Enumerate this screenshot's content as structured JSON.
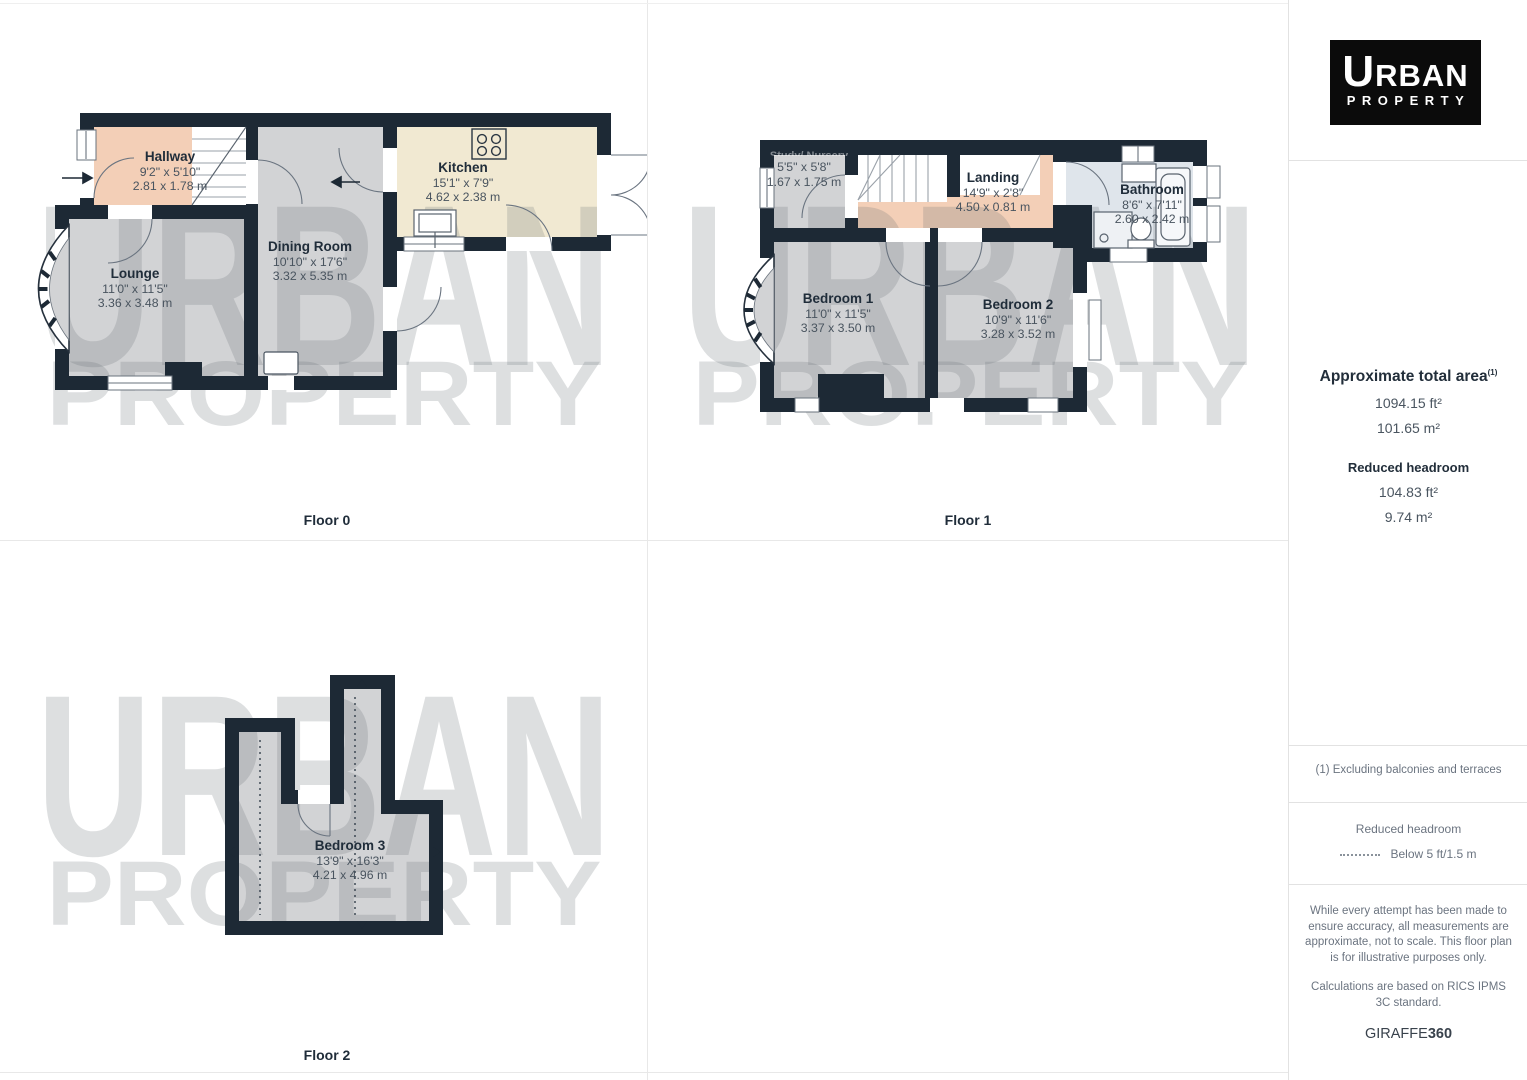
{
  "branding": {
    "logo_word1_first": "U",
    "logo_word1_rest": "RBAN",
    "logo_word2": "PROPERTY"
  },
  "watermark": {
    "line1": "URBAN",
    "line2": "PROPERTY"
  },
  "floors": [
    {
      "label": "Floor 0",
      "rooms": [
        {
          "name": "Hallway",
          "imperial": "9'2\" x 5'10\"",
          "metric": "2.81 x 1.78 m"
        },
        {
          "name": "Lounge",
          "imperial": "11'0\" x 11'5\"",
          "metric": "3.36 x 3.48 m"
        },
        {
          "name": "Dining Room",
          "imperial": "10'10\" x 17'6\"",
          "metric": "3.32 x 5.35 m"
        },
        {
          "name": "Kitchen",
          "imperial": "15'1\" x 7'9\"",
          "metric": "4.62 x 2.38 m"
        }
      ]
    },
    {
      "label": "Floor 1",
      "rooms": [
        {
          "name": "Study/ Nursery",
          "imperial": "5'5\" x 5'8\"",
          "metric": "1.67 x 1.75 m"
        },
        {
          "name": "Landing",
          "imperial": "14'9\" x 2'8\"",
          "metric": "4.50 x 0.81 m"
        },
        {
          "name": "Bathroom",
          "imperial": "8'6\" x 7'11\"",
          "metric": "2.60 x 2.42 m"
        },
        {
          "name": "Bedroom 1",
          "imperial": "11'0\" x 11'5\"",
          "metric": "3.37 x 3.50 m"
        },
        {
          "name": "Bedroom 2",
          "imperial": "10'9\" x 11'6\"",
          "metric": "3.28 x 3.52 m"
        }
      ]
    },
    {
      "label": "Floor 2",
      "rooms": [
        {
          "name": "Bedroom 3",
          "imperial": "13'9\" x 16'3\"",
          "metric": "4.21 x 4.96 m"
        }
      ]
    }
  ],
  "sidebar": {
    "total_area": {
      "heading": "Approximate total area",
      "sup": "(1)",
      "ft": "1094.15 ft²",
      "m": "101.65 m²"
    },
    "reduced_headroom": {
      "heading": "Reduced headroom",
      "ft": "104.83 ft²",
      "m": "9.74 m²"
    },
    "footnote": "(1) Excluding balconies and terraces",
    "legend": {
      "title": "Reduced headroom",
      "label": "Below 5 ft/1.5 m"
    },
    "disclaimer_p1": "While every attempt has been made to ensure accuracy, all measurements are approximate, not to scale. This floor plan is for illustrative purposes only.",
    "disclaimer_p2": "Calculations are based on RICS IPMS 3C standard.",
    "credit": {
      "normal": "GIRAFFE",
      "bold": "360"
    }
  },
  "colors": {
    "wall": "#1d2935",
    "room_gray": "#d2d3d5",
    "room_peach": "#f3cfb7",
    "room_cream": "#f1e9d2",
    "room_blue": "#dfe5eb",
    "watermark_tint": "rgba(100,108,116,0.22)"
  }
}
